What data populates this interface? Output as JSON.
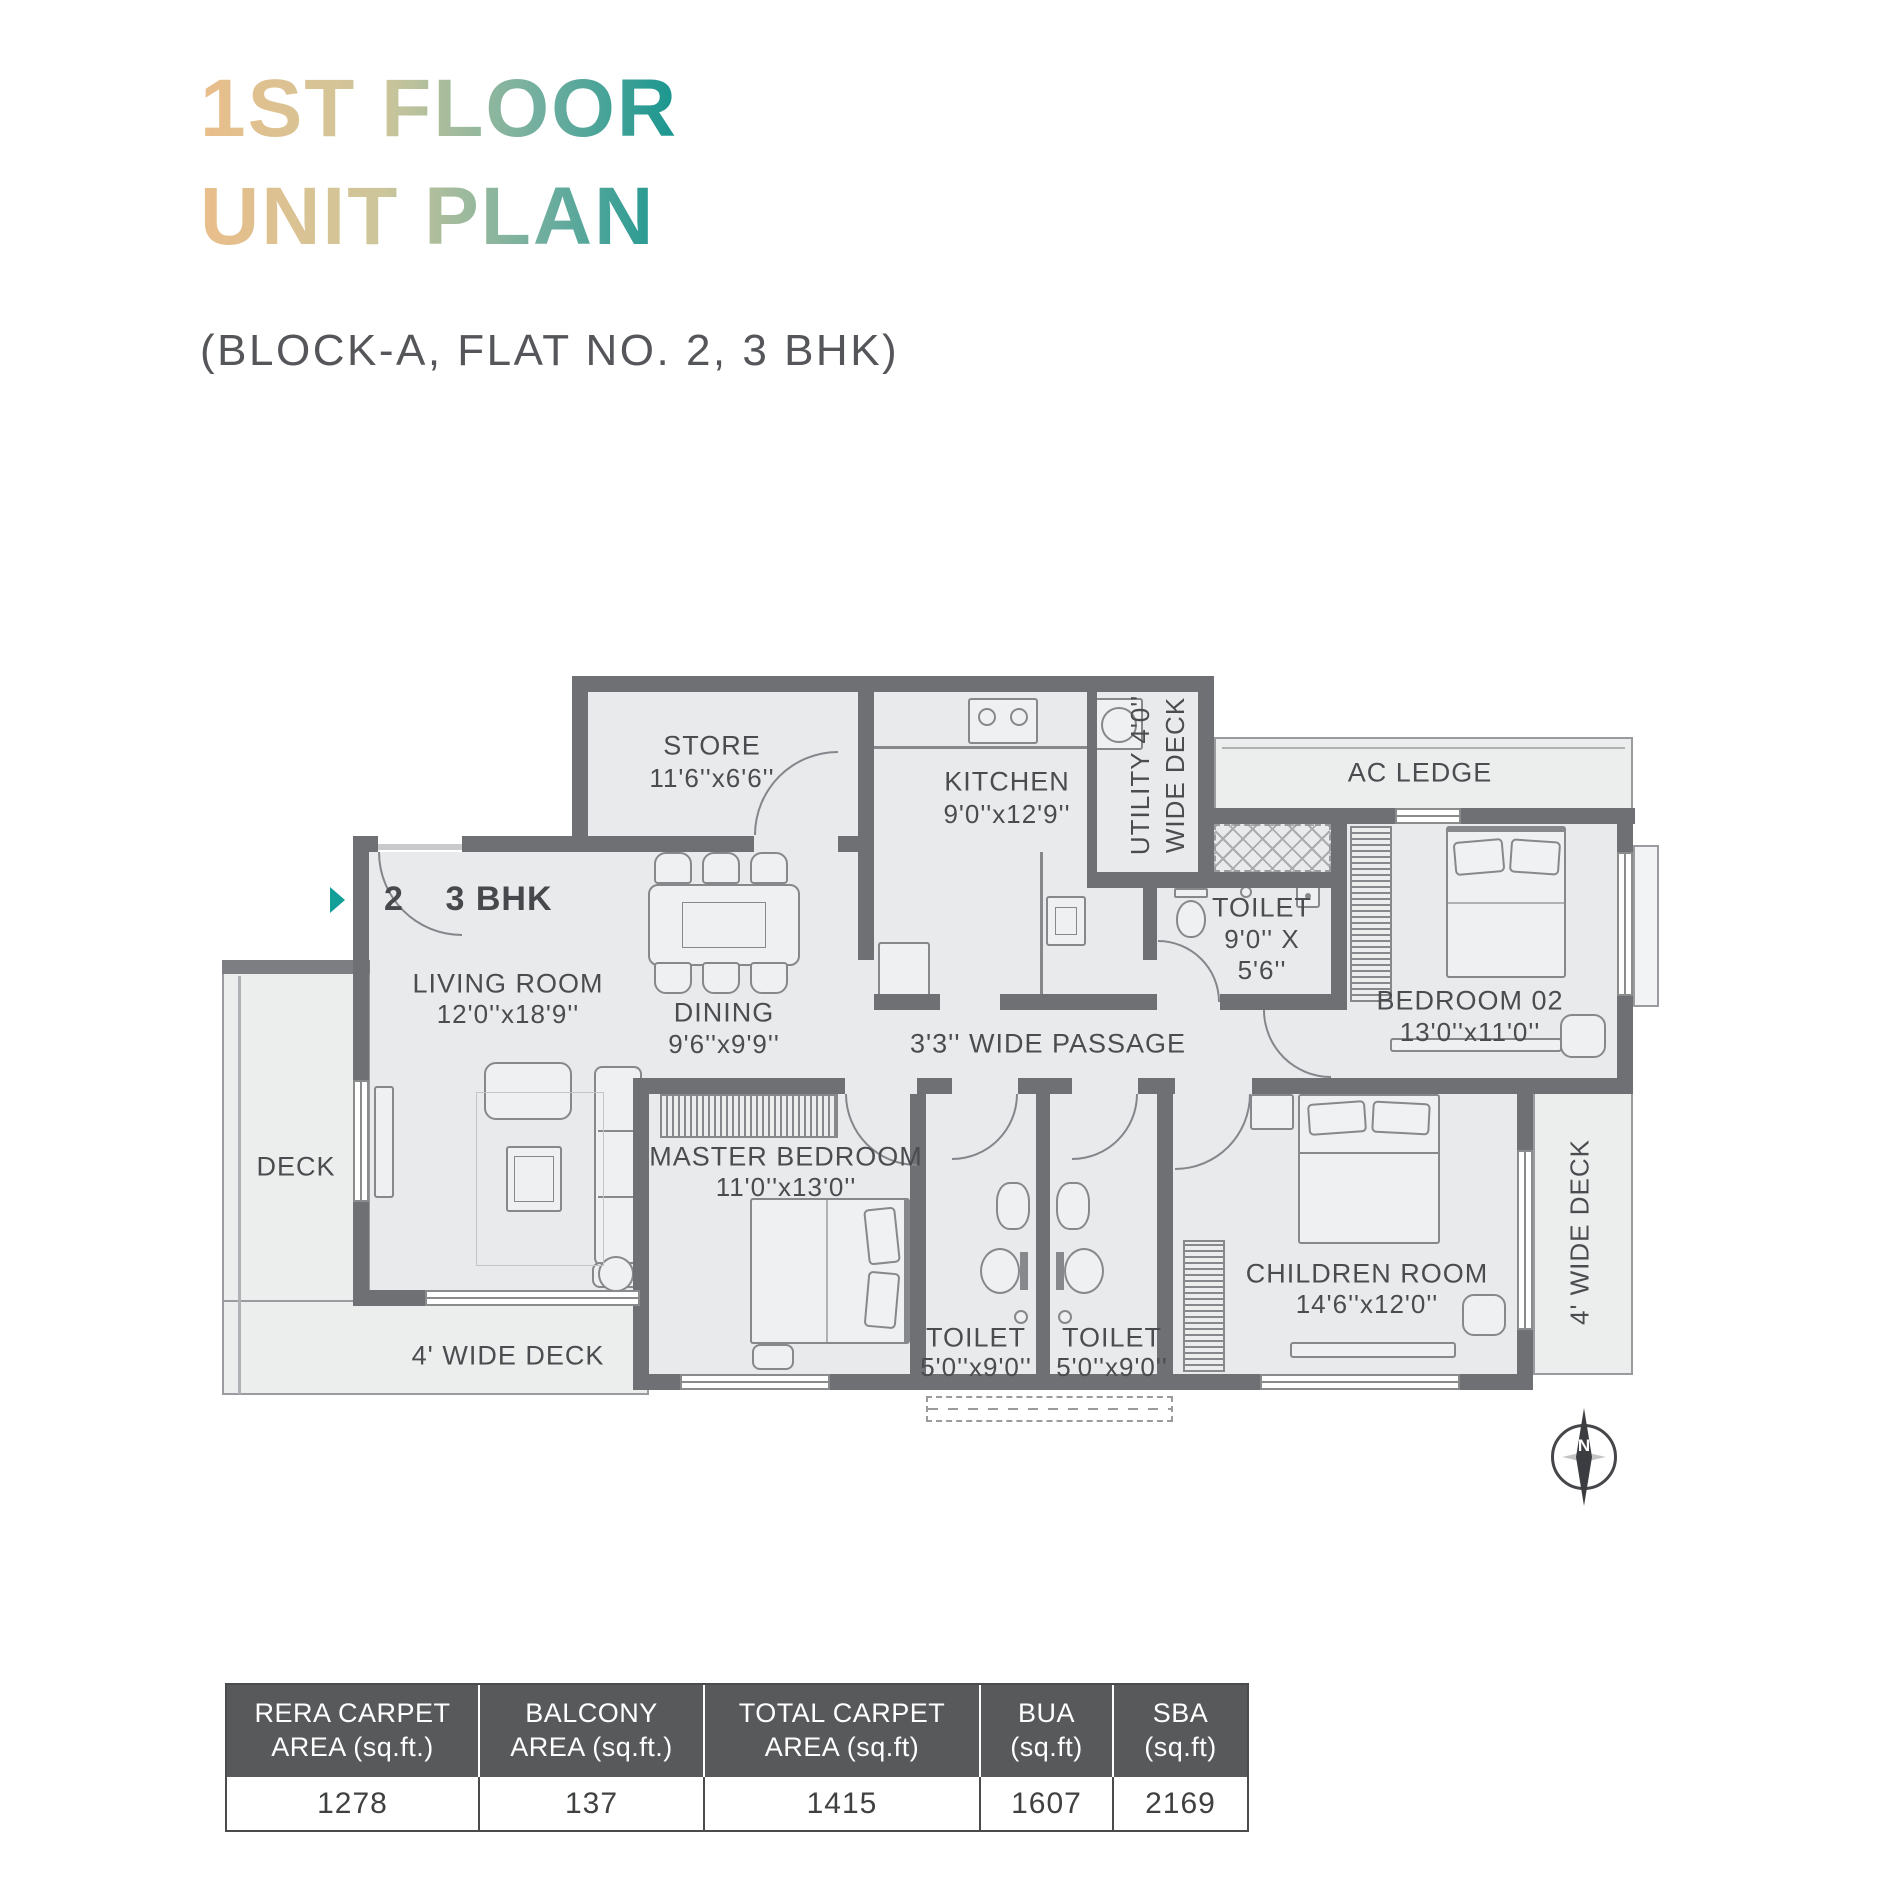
{
  "title": {
    "line1": "1ST FLOOR",
    "line2": "UNIT PLAN"
  },
  "subtitle": "(BLOCK-A, FLAT NO. 2, 3 BHK)",
  "colors": {
    "accent_teal": "#14a099",
    "wall_gray": "#6f7073",
    "room_fill": "#e9eaec",
    "table_header_bg": "#58595b"
  },
  "plan": {
    "entry": {
      "number": "2",
      "type": "3 BHK"
    },
    "compass": "N",
    "rooms": {
      "store": {
        "name": "STORE",
        "dims": "11'6''x6'6''"
      },
      "kitchen": {
        "name": "KITCHEN",
        "dims": "9'0''x12'9''"
      },
      "utility": {
        "line1": "UTILITY 4'0''",
        "line2": "WIDE DECK"
      },
      "ac_ledge": {
        "name": "AC LEDGE"
      },
      "toilet_attached": {
        "name": "TOILET",
        "dims_line1": "9'0'' X",
        "dims_line2": "5'6''"
      },
      "bedroom02": {
        "name": "BEDROOM 02",
        "dims": "13'0''x11'0''"
      },
      "living": {
        "name": "LIVING ROOM",
        "dims": "12'0''x18'9''"
      },
      "dining": {
        "name": "DINING",
        "dims": "9'6''x9'9''"
      },
      "passage": {
        "name": "3'3'' WIDE PASSAGE"
      },
      "deck": {
        "name": "DECK"
      },
      "master": {
        "name": "MASTER BEDROOM",
        "dims": "11'0''x13'0''"
      },
      "toilet1": {
        "name": "TOILET",
        "dims": "5'0''x9'0''"
      },
      "toilet2": {
        "name": "TOILET",
        "dims": "5'0''x9'0''"
      },
      "children": {
        "name": "CHILDREN ROOM",
        "dims": "14'6''x12'0''"
      },
      "deck_bottom": {
        "name": "4' WIDE DECK"
      },
      "deck_right": {
        "name": "4' WIDE DECK"
      }
    }
  },
  "table": {
    "headers": [
      [
        "RERA CARPET",
        "AREA (sq.ft.)"
      ],
      [
        "BALCONY",
        "AREA (sq.ft.)"
      ],
      [
        "TOTAL CARPET",
        "AREA (sq.ft)"
      ],
      [
        "BUA",
        "(sq.ft)"
      ],
      [
        "SBA",
        "(sq.ft)"
      ]
    ],
    "values": [
      "1278",
      "137",
      "1415",
      "1607",
      "2169"
    ]
  }
}
